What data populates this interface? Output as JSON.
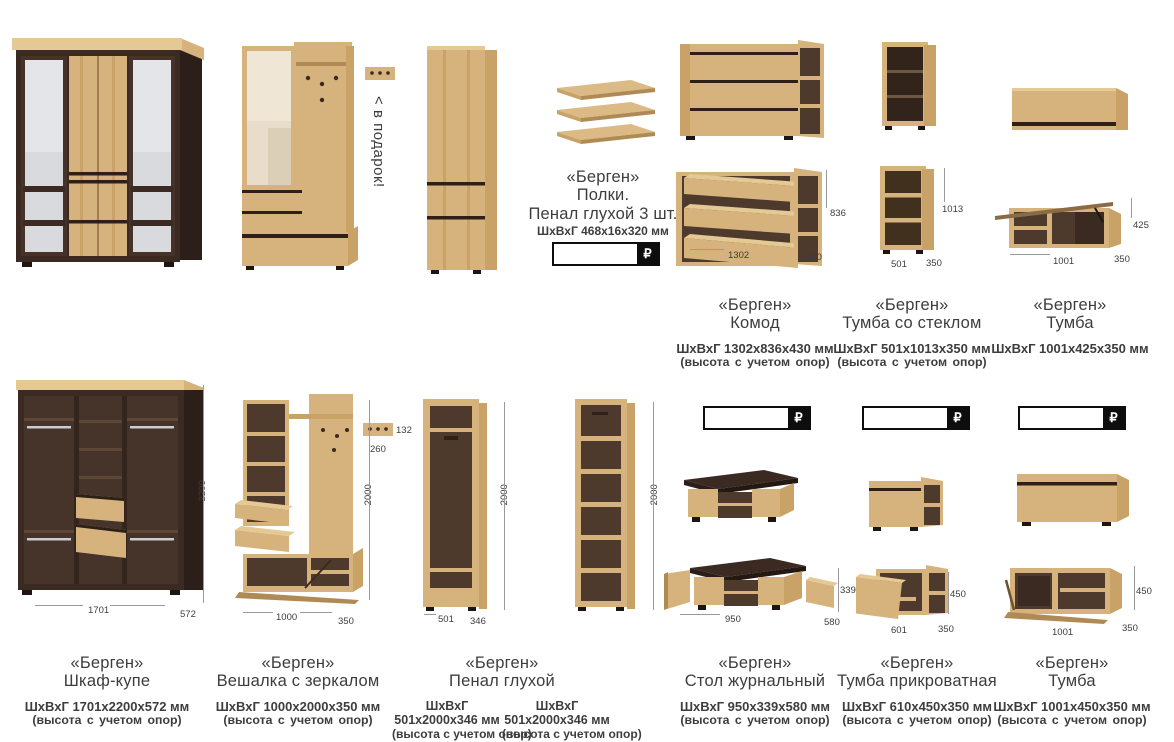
{
  "currency": "₽",
  "gift": {
    "arrow": "<",
    "label": "в подарок!"
  },
  "cards": {
    "shelves": {
      "brand": "«Берген»",
      "name": "Полки.",
      "name2": "Пенал глухой 3 шт.",
      "dims": "ШхВхГ 468х16х320 мм"
    },
    "komod": {
      "brand": "«Берген»",
      "name": "Комод",
      "dims": "ШхВхГ 1302х836х430 мм",
      "note": "(высота с учетом опор)",
      "m_w": "1302",
      "m_h": "836",
      "m_d": "430"
    },
    "tumba_glass": {
      "brand": "«Берген»",
      "name": "Тумба со стеклом",
      "dims": "ШхВхГ 501х1013х350 мм",
      "note": "(высота с учетом опор)",
      "m_w": "501",
      "m_h": "1013",
      "m_d": "350"
    },
    "tumba_wall": {
      "brand": "«Берген»",
      "name": "Тумба",
      "dims": "ШхВхГ 1001х425х350 мм",
      "m_w": "1001",
      "m_h": "425",
      "m_d": "350"
    },
    "wardrobe": {
      "brand": "«Берген»",
      "name": "Шкаф-купе",
      "dims": "ШхВхГ 1701х2200х572 мм",
      "note": "(высота с учетом опор)",
      "m_w": "1701",
      "m_h": "2200",
      "m_d": "572"
    },
    "hanger": {
      "brand": "«Берген»",
      "name": "Вешалка с зеркалом",
      "dims": "ШхВхГ 1000х2000х350 мм",
      "note": "(высота с учетом опор)",
      "m_w": "1000",
      "m_h": "2000",
      "m_d": "350",
      "key_w": "260",
      "key_h": "132"
    },
    "penal": {
      "brand": "«Берген»",
      "name": "Пенал глухой",
      "dims_label": "ШхВхГ",
      "dims_value": "501х2000х346 мм",
      "note": "(высота с учетом опор)",
      "note_extra": "полки преобретаются",
      "m_w": "501",
      "m_h": "2000",
      "m_d": "346"
    },
    "table": {
      "brand": "«Берген»",
      "name": "Стол журнальный",
      "dims": "ШхВхГ 950х339х580 мм",
      "note": "(высота с учетом опор)",
      "m_w": "950",
      "m_h": "339",
      "m_d": "580"
    },
    "tumba_bed": {
      "brand": "«Берген»",
      "name": "Тумба прикроватная",
      "dims": "ШхВхГ 610х450х350 мм",
      "note": "(высота с учетом опор)",
      "m_w": "601",
      "m_h": "450",
      "m_d": "350"
    },
    "tumba_wide": {
      "brand": "«Берген»",
      "name": "Тумба",
      "dims": "ШхВхГ 1001х450х350 мм",
      "note": "(высота с учетом опор)",
      "m_w": "1001",
      "m_h": "450",
      "m_d": "350"
    }
  }
}
